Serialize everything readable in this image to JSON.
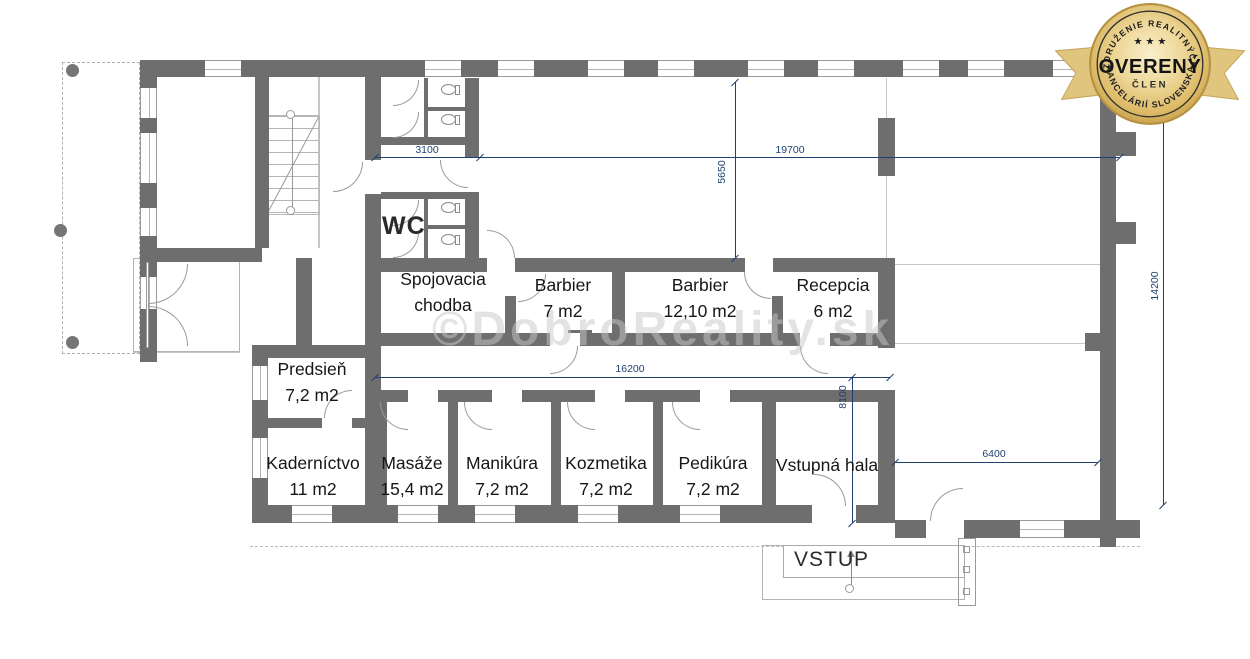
{
  "badge": {
    "arc_top": "ZDRUŽENIE REALITNÝCH",
    "stars": "★ ★ ★",
    "title": "OVERENÝ",
    "member": "ČLEN",
    "arc_bottom": "KANCELÁRIÍ SLOVENSKA"
  },
  "watermark": {
    "text": "©DobroReality.sk"
  },
  "rooms": {
    "spojovacia": {
      "label": "Spojovacia chodba"
    },
    "barbier1": {
      "label": "Barbier",
      "area": "7 m2"
    },
    "barbier2": {
      "label": "Barbier",
      "area": "12,10 m2"
    },
    "recepcia": {
      "label": "Recepcia",
      "area": "6 m2"
    },
    "predsien": {
      "label": "Predsieň",
      "area": "7,2 m2"
    },
    "wc": {
      "label": "WC"
    },
    "kadernictvo": {
      "label": "Kaderníctvo",
      "area": "11 m2"
    },
    "masaze": {
      "label": "Masáže",
      "area": "15,4 m2"
    },
    "manikura": {
      "label": "Manikúra",
      "area": "7,2 m2"
    },
    "kozmetika": {
      "label": "Kozmetika",
      "area": "7,2 m2"
    },
    "pedikura": {
      "label": "Pedikúra",
      "area": "7,2 m2"
    },
    "vstupna_hala": {
      "label": "Vstupná hala"
    }
  },
  "entrance": {
    "label": "VSTUP"
  },
  "dimensions": {
    "top_left": "3100",
    "top_right": "19700",
    "upper_vertical": "5650",
    "middle": "16200",
    "middle_vertical": "8100",
    "right": "6400",
    "right_vertical": "14200"
  },
  "colors": {
    "wall": "#6e6e6e",
    "dimension": "#1f4070",
    "badge_gold": "#d9b45c",
    "watermark": "#c9c9c9"
  }
}
